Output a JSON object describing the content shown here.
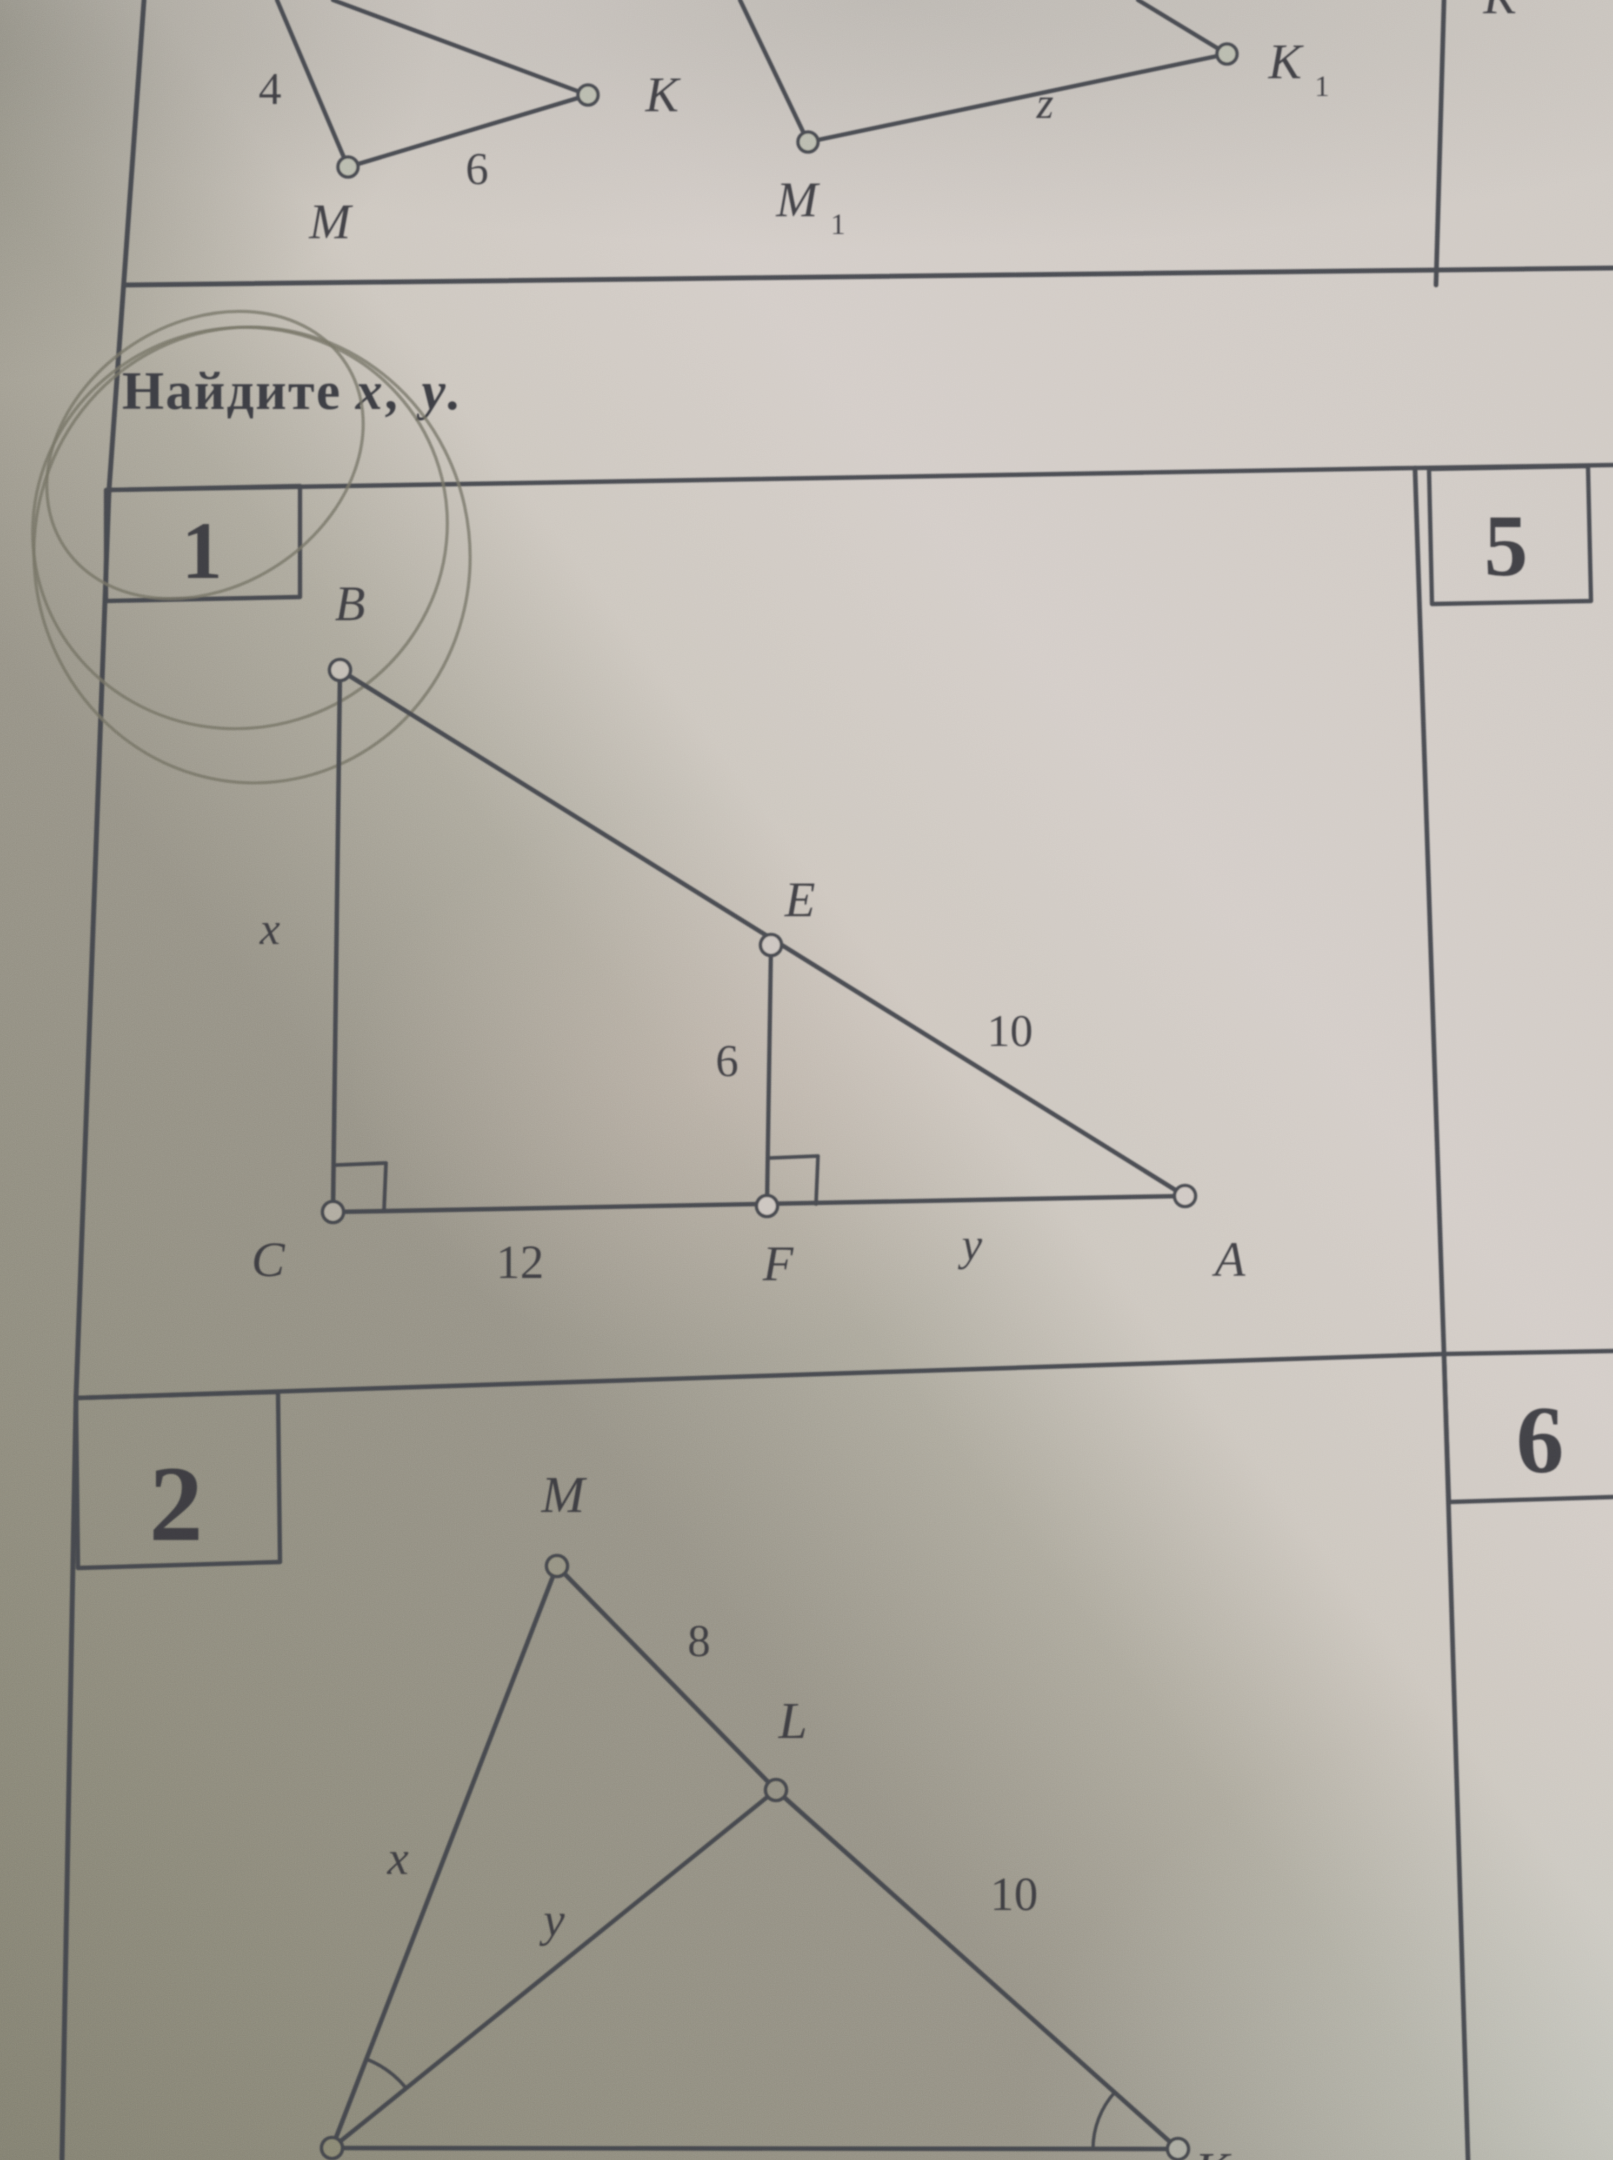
{
  "heading": {
    "word": "Найдите",
    "vars": "x, y."
  },
  "top_row": {
    "left_triangle": {
      "side_left": "4",
      "side_bottom": "6",
      "vertex_bottom": "M",
      "vertex_right": "K"
    },
    "middle_triangle": {
      "vertex_bottom": "M",
      "vertex_bottom_sub": "1",
      "vertex_right": "K",
      "vertex_right_sub": "1",
      "side_bottom": "z"
    },
    "right_cell_fragment": "K"
  },
  "problem_1": {
    "number": "1",
    "points": {
      "b": "B",
      "e": "E",
      "c": "C",
      "f": "F",
      "a": "A"
    },
    "measures": {
      "side_bc": "x",
      "segment_ef": "6",
      "segment_cf": "12",
      "segment_fa": "y",
      "segment_ea": "10"
    }
  },
  "problem_5": {
    "number": "5"
  },
  "problem_2": {
    "number": "2",
    "points": {
      "m": "M",
      "l": "L",
      "k": "K"
    },
    "measures": {
      "side_mn": "x",
      "segment_ml": "8",
      "segment_nl": "y",
      "segment_lk": "10"
    }
  },
  "problem_6": {
    "number": "6"
  }
}
